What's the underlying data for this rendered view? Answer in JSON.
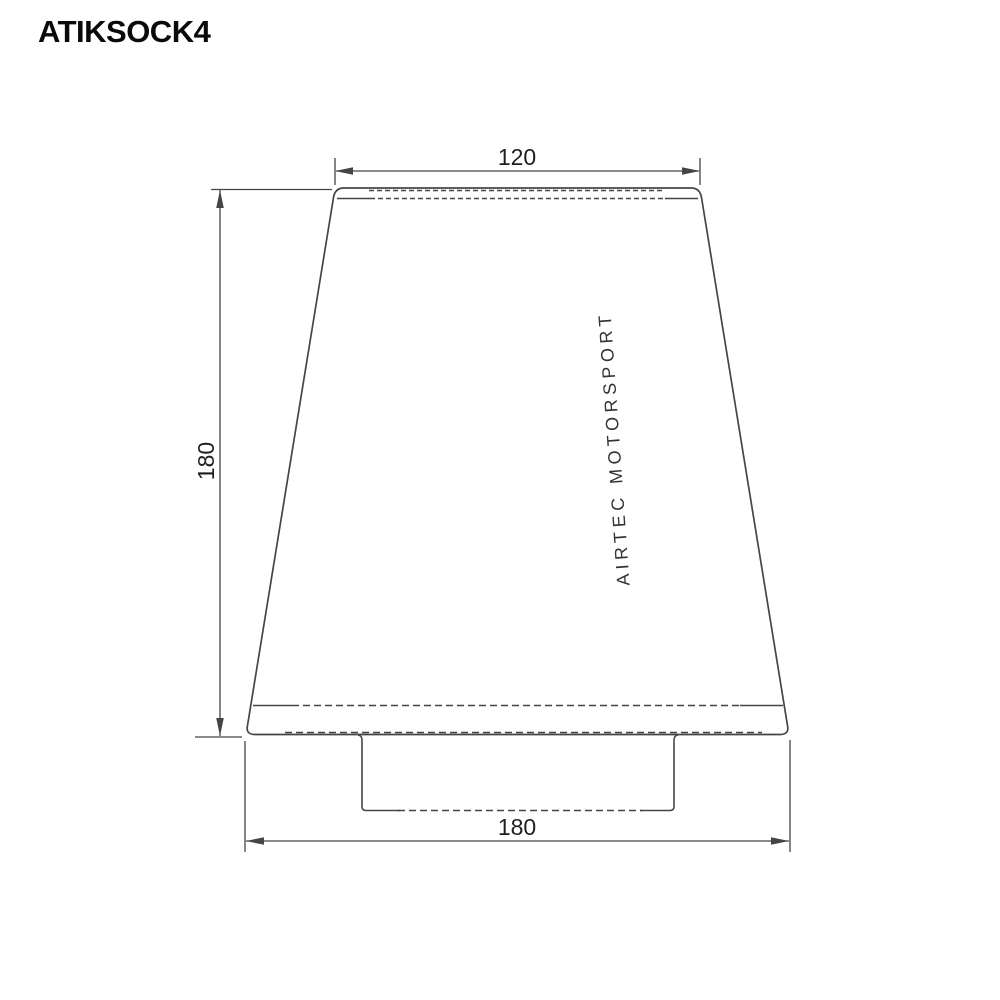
{
  "header": {
    "title": "ATIKSOCK4"
  },
  "drawing": {
    "type": "technical-dimension-drawing",
    "subject": "cone air filter front view",
    "brand_label": "AIRTEC MOTORSPORT",
    "dimensions": {
      "top_width": "120",
      "height": "180",
      "base_width": "180"
    }
  },
  "colors": {
    "background": "#ffffff",
    "line": "#454545",
    "dim_text": "#1f1f1f",
    "title_text": "#0a0a0a",
    "brand_text": "#333333"
  }
}
